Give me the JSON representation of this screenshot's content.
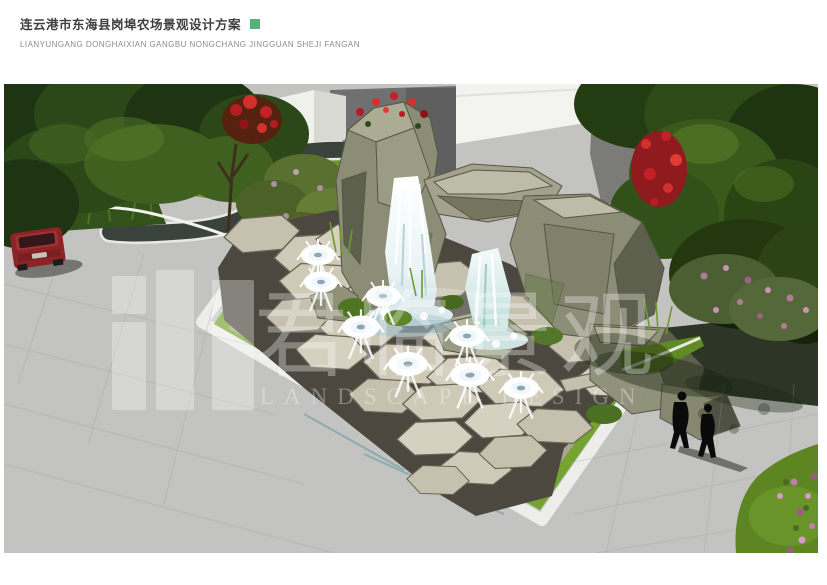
{
  "header": {
    "title_cn": "连云港市东海县岗埠农场景观设计方案",
    "title_pinyin": "LIANYUNGANG DONGHAIXIAN GANGBU NONGCHANG JINGGUAN SHEJI FANGAN",
    "accent_color": "#54b37c"
  },
  "render": {
    "watermark_cn": "君临景观",
    "watermark_en": "LANDSCAPE DESIGN",
    "colors": {
      "pond_water": "#1c4a50",
      "lawn_green": "#6f9430",
      "plaza_stone": "#cfc9b8",
      "rock_gray": "#8b8d76",
      "road_gray": "#c3c3c1",
      "red_flowers": "#c42127",
      "pink_flowers": "#b07c98",
      "car_red": "#8c2427"
    }
  }
}
